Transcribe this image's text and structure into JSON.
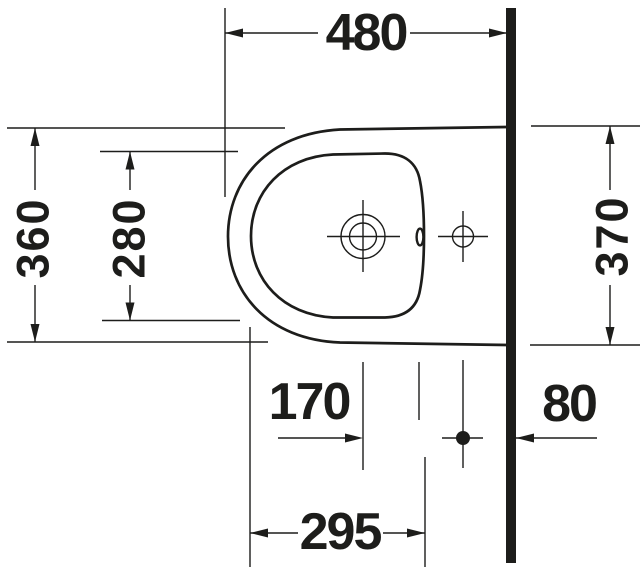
{
  "page": {
    "background_color": "#ffffff",
    "ink_color": "#1d1d1b"
  },
  "drawing": {
    "kind": "technical-dimension-drawing",
    "subject": "wall-mounted bidet, top (plan) view",
    "labels": {
      "projection_480": "480",
      "front_width_360": "360",
      "bowl_width_280": "280",
      "wall_width_370": "370",
      "tap_to_drain_170": "170",
      "drain_to_wall_80": "80",
      "bowl_length_295": "295"
    }
  }
}
